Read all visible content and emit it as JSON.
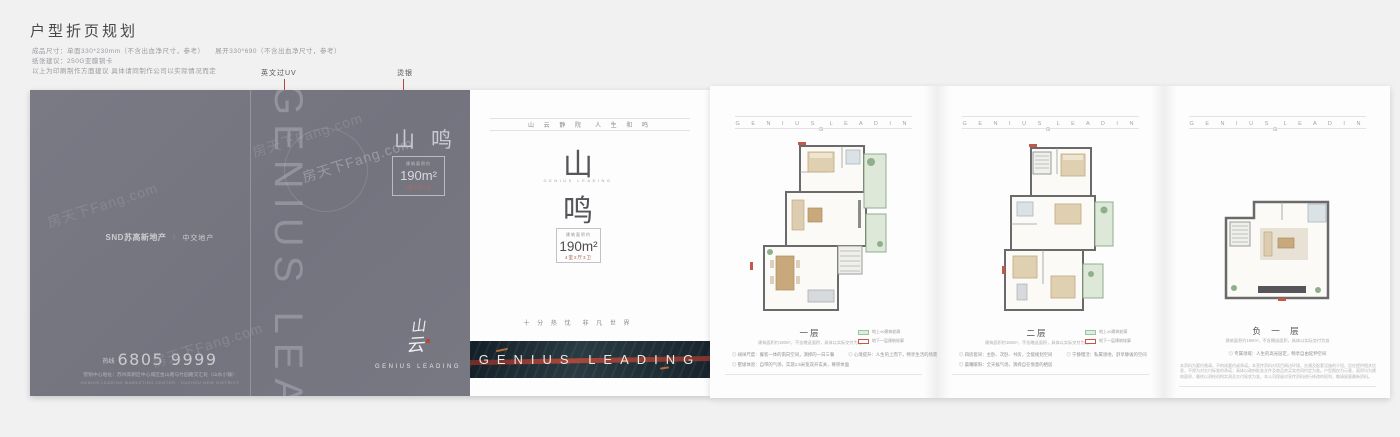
{
  "meta": {
    "watermark": "房天下Fang.com"
  },
  "header": {
    "title": "户型折页规划",
    "spec_line1": "成品尺寸：单面330*230mm（不含出血净尺寸，参考）　　展开330*690（不含出血净尺寸，参考）",
    "spec_line2": "纸张建议：250G亚膜铜卡",
    "spec_line3": "以上为印刷制作方面建议 具体请同制作公司以实际情况而定",
    "annotation_uv": "英文过UV",
    "annotation_silver": "烫银"
  },
  "back_cover": {
    "vertical_text": "GENIUS LEADING",
    "brand_left": "SND苏高新地产",
    "brand_sep": "｜",
    "brand_right": "中交地产",
    "hotline_label": "热线",
    "phone": "6805 9999",
    "address": "营销中心地址：苏州高新区中心城区金山路与竹园路交汇处（山水小镇）",
    "address_en": "GENIUS LEADING MARKETING CENTER · SUZHOU NEW DISTRICT"
  },
  "flap": {
    "product_name": "山鸣",
    "area_label": "建筑面积约",
    "area_value": "190m²",
    "layout": "4室2厅3卫",
    "calligraphy_char1": "山",
    "calligraphy_char2": "云",
    "logo_caption": "GENIUS LEADING"
  },
  "cover": {
    "tagline_top": "山 云 静 院　人 生 和 鸣",
    "name_char1": "山",
    "name_char2": "鸣",
    "name_en": "GENIUS LEADING",
    "area_label": "建筑面积约",
    "area_value": "190m²",
    "layout": "4室2厅3卫",
    "tagline_bottom": "十 分 热 忱　非 凡 世 界",
    "band_text": "GENIUS LEADING"
  },
  "panels": [
    {
      "header_letters": "G E N I U S　L E A D I N G",
      "floor_title": "一层",
      "floor_sub": "建筑面积约190m²，不含赠送面积，具体以实际交付为准",
      "legend": [
        {
          "label": "地上±0建筑轮廓"
        },
        {
          "label": "地下一层建筑轮廓"
        }
      ],
      "bullets": [
        "◎ 阔绰尺度：餐客一体的南向空间，演绎的一日三餐",
        "◎ 心境提升：人生的上而下，畅享生活的场景",
        "◎ 墅级体验：自带的气场，实现1.5米宽双开玄关，尊崇体面"
      ]
    },
    {
      "header_letters": "G E N I U S　L E A D I N G",
      "floor_title": "二层",
      "floor_sub": "建筑面积约190m²，不含赠送面积，具体以实际交付为准",
      "legend": [
        {
          "label": "地上±0建筑轮廓"
        },
        {
          "label": "地下一层建筑轮廓"
        }
      ],
      "bullets": [
        "◎ 四房套间：主卧、次卧、书房，全能规划空间",
        "◎ 宁静慢活：私属领地，舒享静谧的空间",
        "◎ 晨曦暖阳：全天候气场，演绎自在惬意的栖居"
      ]
    },
    {
      "header_letters": "G E N I U S　L E A D I N G",
      "floor_title": "负 一 层",
      "floor_sub": "建筑面积约190m²，不含赠送面积，具体以实际交付为准",
      "bullets": [
        "◎ 专属领域：人生的高光层定，畅享自由延伸空间"
      ],
      "disclaimer": "本资料为要约邀请，不构成要约或承诺。本宣传资料对项目周边环境、交通及配套设施的介绍，旨在提供相关信息，不视为对交付标准的承诺；具体以政府批准文件及商品房买卖合同约定为准。户型图仅为示意，面积均为建筑面积，最终以测绘机构实测及交付现状为准。本公司保留对宣传资料进行修改的权利，敬请留意最新资料。"
    }
  ]
}
